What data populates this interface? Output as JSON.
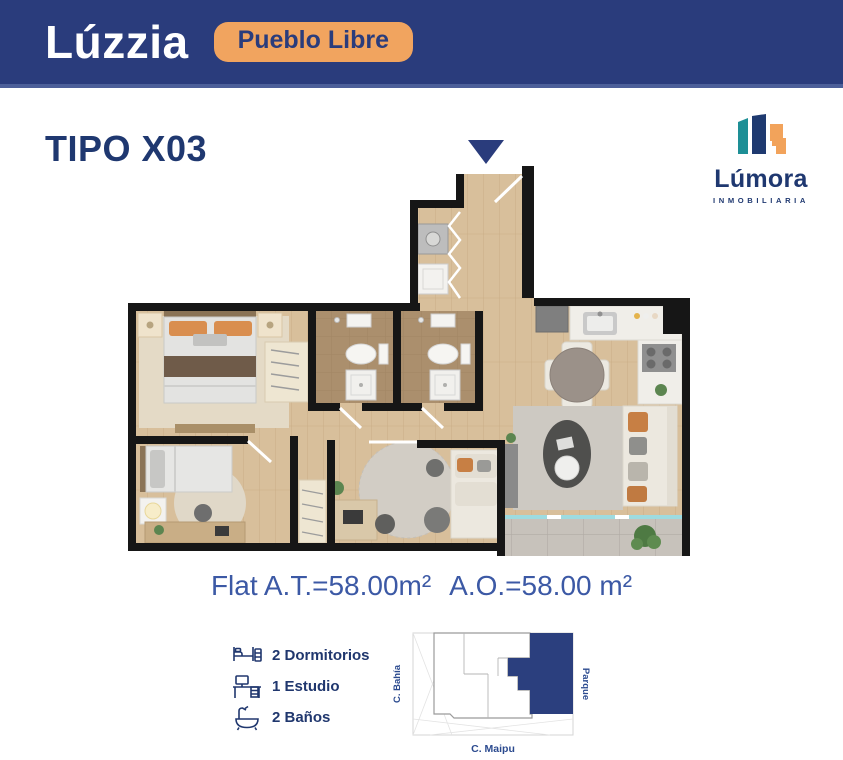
{
  "header": {
    "brand": "Lúzzia",
    "location_badge": "Pueblo Libre"
  },
  "page": {
    "title": "TIPO X03"
  },
  "developer": {
    "name": "Lúmora",
    "subtitle": "INMOBILIARIA"
  },
  "areas": {
    "flat": "Flat A.T.=58.00m²",
    "official": "A.O.=58.00 m²"
  },
  "features": [
    {
      "icon": "bed-icon",
      "label": "2 Dormitorios"
    },
    {
      "icon": "desk-icon",
      "label": "1 Estudio"
    },
    {
      "icon": "bathtub-icon",
      "label": "2 Baños"
    }
  ],
  "site_map": {
    "left_street": "C. Bahía",
    "right_label": "Parque",
    "bottom_street": "C. Maipu"
  },
  "colors": {
    "navy": "#2A3C7C",
    "orange": "#F1A45F",
    "title-navy": "#1F3870",
    "area-blue": "#3C59A5",
    "legend-navy": "#20376E",
    "map-navy": "#2B3F7E"
  }
}
